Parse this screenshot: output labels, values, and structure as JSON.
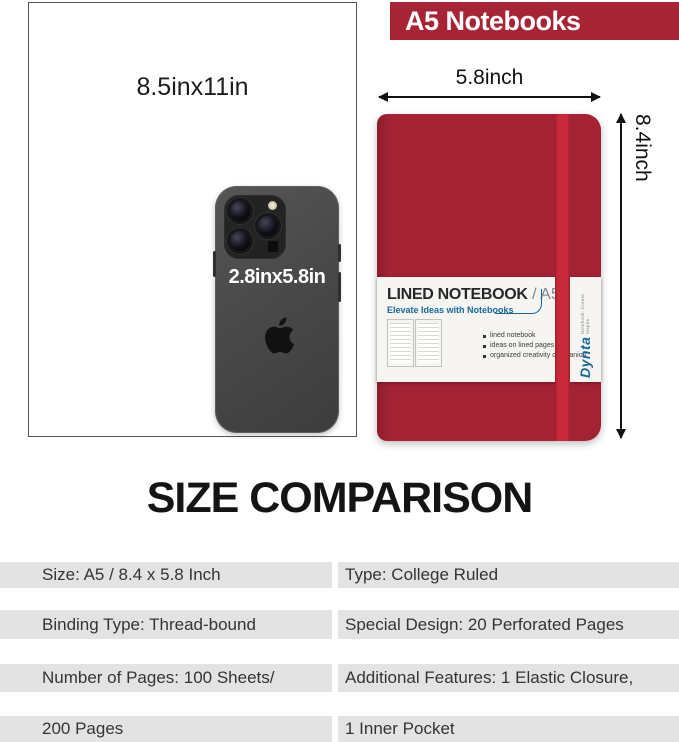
{
  "colors": {
    "brand-red": "#a62433",
    "notebook-red": "#a32335",
    "elastic-red": "#c92a3a",
    "accent-blue": "#16689c",
    "stripe-gray": "#e3e3e3"
  },
  "banner": {
    "title": "A5 Notebooks"
  },
  "comparison": {
    "paper_label": "8.5inx11in",
    "phone_label": "2.8inx5.8in",
    "notebook_width_label": "5.8inch",
    "notebook_height_label": "8.4inch"
  },
  "notebook_label": {
    "title": "LINED NOTEBOOK",
    "title_suffix": "/ A5",
    "subtitle": "Elevate Ideas with Notebooks",
    "features": [
      "lined notebook",
      "ideas on lined pages",
      "organized creativity companion"
    ],
    "brand": "Dynta",
    "brand_tagline": "Notebook. Create. Inspire."
  },
  "heading": "SIZE COMPARISON",
  "specs": {
    "rows": [
      {
        "left": "Size: A5 / 8.4 x 5.8 Inch",
        "right": "Type: College Ruled"
      },
      {
        "left": "Binding Type: Thread-bound",
        "right": "Special Design: 20 Perforated Pages"
      },
      {
        "left": "Number of Pages: 100 Sheets/",
        "right": "Additional Features: 1 Elastic Closure,"
      },
      {
        "left": "200 Pages",
        "right": "1 Inner Pocket"
      }
    ]
  }
}
